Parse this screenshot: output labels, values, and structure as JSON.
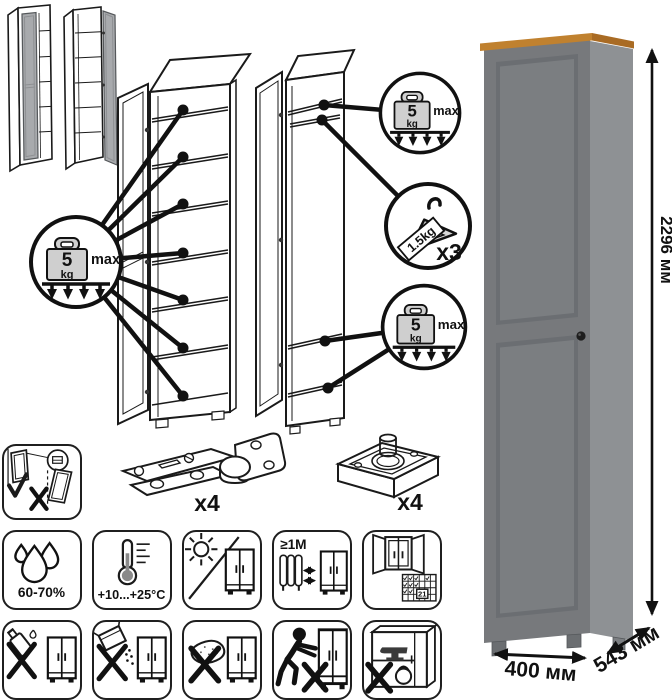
{
  "load_badge": {
    "value": "5",
    "unit": "kg",
    "max_label": "max"
  },
  "hanger_badge": {
    "load_label": "1.5kg",
    "count_label": "x3"
  },
  "hardware": {
    "hinge_count_label": "x4",
    "foot_count_label": "x4"
  },
  "dimensions": {
    "height_label": "2296 мм",
    "width_label": "400 мм",
    "depth_label": "543 мм"
  },
  "care": {
    "humidity_label": "60-70%",
    "temperature_label": "+10...+25°C",
    "distance_label": "≥1M",
    "calendar_day_label": "21"
  },
  "icons": [
    "closed-cabinet-icon",
    "open-cabinet-icon",
    "shelf-load-badge",
    "hanger-load-badge",
    "hinge-icon",
    "adjustable-foot-icon",
    "wall-anchor-warning-icon",
    "humidity-icon",
    "temperature-icon",
    "no-direct-sunlight-icon",
    "heat-distance-icon",
    "ventilation-calendar-icon",
    "no-liquid-cleaner-icon",
    "no-abrasive-powder-icon",
    "no-wet-sponge-icon",
    "no-dragging-icon",
    "no-overload-icon"
  ],
  "colors": {
    "wardrobe_front": "#77797c",
    "wardrobe_side": "#8e9194",
    "wood_top": "#c0812f",
    "door_gray": "#a8aaad",
    "line_art": "#1a1a1a"
  }
}
